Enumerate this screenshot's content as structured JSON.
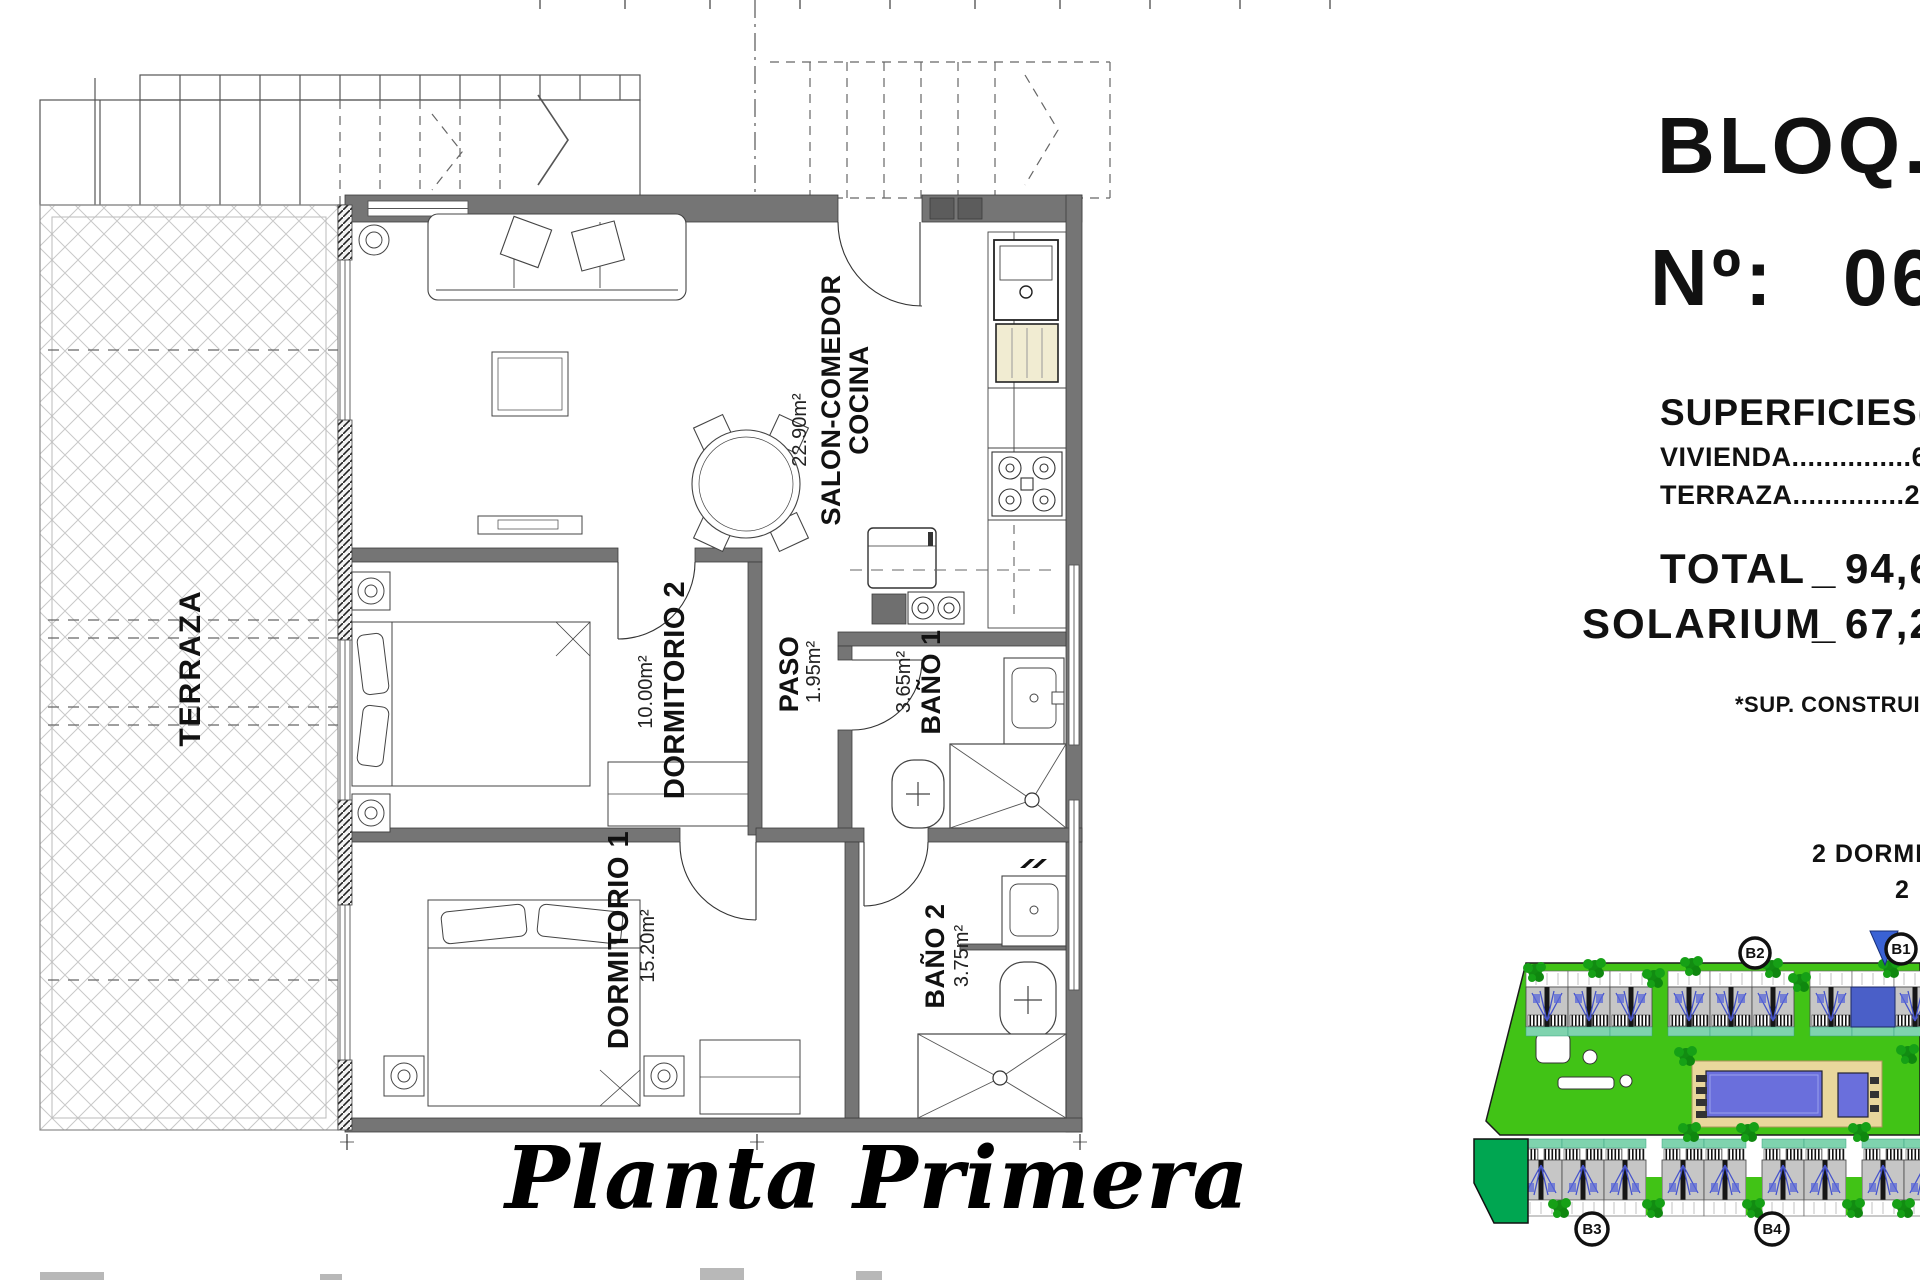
{
  "floor_plan": {
    "title": "Planta Primera",
    "rooms": {
      "terraza": {
        "name": "TERRAZA"
      },
      "salon": {
        "name_line1": "SALON-COMEDOR",
        "name_line2": "COCINA",
        "area": "22.90m²"
      },
      "dormitorio2": {
        "name": "DORMITORIO 2",
        "area": "10.00m²"
      },
      "paso": {
        "name": "PASO",
        "area": "1.95m²"
      },
      "bano1": {
        "name": "BAÑO 1",
        "area": "3.65m²"
      },
      "dormitorio1": {
        "name": "DORMITORIO 1",
        "area": "15.20m²"
      },
      "bano2": {
        "name": "BAÑO 2",
        "area": "3.75m²"
      }
    }
  },
  "info_panel": {
    "bloq_label": "BLOQ.",
    "numero_label": "Nº:",
    "numero_value": "06",
    "superficies_title": "SUPERFICIES(M",
    "vivienda_label": "VIVIENDA",
    "vivienda_dots": "...............",
    "vivienda_value": "67,2",
    "terraza_label": "TERRAZA",
    "terraza_dots": "..............",
    "terraza_value": "27,4",
    "total_label": "TOTAL",
    "total_separator": "_",
    "total_value": "94,6",
    "solarium_label": "SOLARIUM",
    "solarium_separator": "_",
    "solarium_value": "67,2",
    "footnote": "*SUP. CONSTRUIDA",
    "typology_line1": "2 DORMI",
    "typology_line2": "2"
  },
  "site_plan": {
    "labels": {
      "b1": "B1",
      "b2": "B2",
      "b3": "B3",
      "b4": "B4"
    },
    "colors": {
      "grass": "#41c316",
      "dark_green": "#00a651",
      "tree": "#128c12",
      "pool": "#6a6fdc",
      "deck": "#e9d79c",
      "highlight_unit": "#4a5fc8",
      "roof": "#c6c6c6",
      "flag": "#3a62d4"
    }
  }
}
